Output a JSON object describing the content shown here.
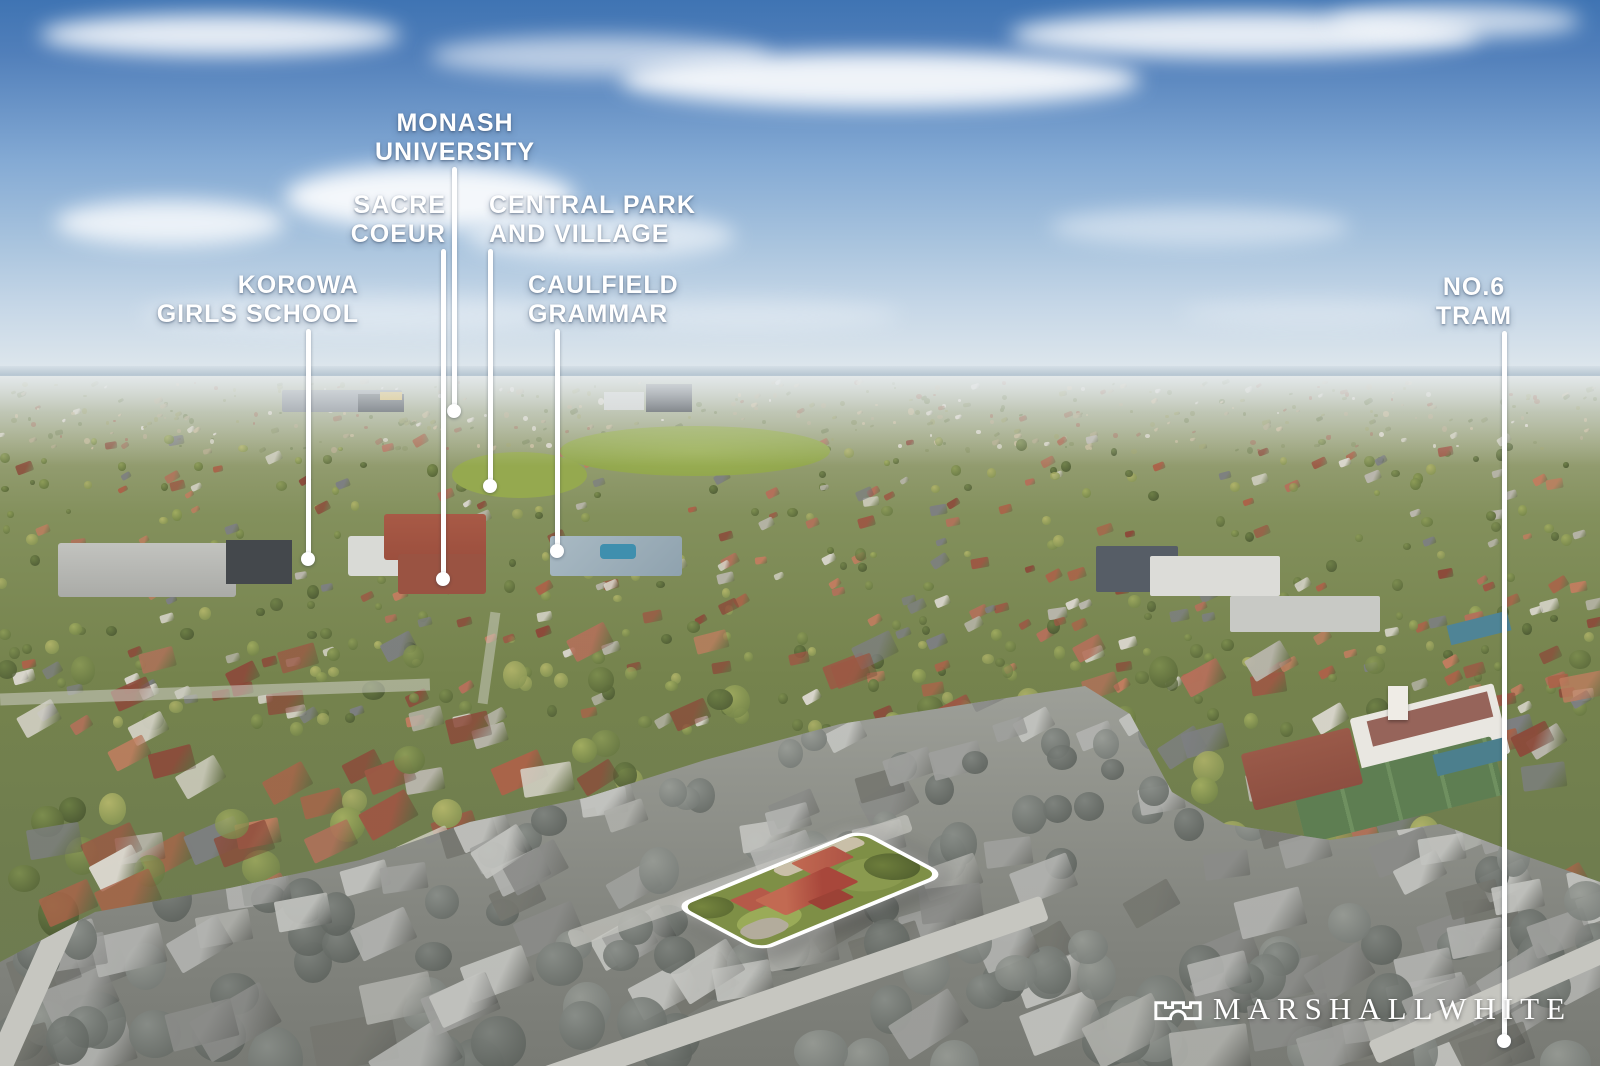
{
  "meta": {
    "description": "Aerial real-estate marketing photograph of a Melbourne suburb with landmark callouts, a white-outlined highlighted property in colour over a desaturated foreground, and agency logo",
    "width": 1600,
    "height": 1066
  },
  "palette": {
    "sky-top": "#3f74b3",
    "sky-mid": "#84aad4",
    "sky-horizon": "#dde6ec",
    "ground-far": "#aab29b",
    "ground-mid": "#75834d",
    "ground-near": "#6e7b52",
    "road-gray": "#c6c6c0",
    "lawn-green": "#7e8f46",
    "roof-red": "#a8473b",
    "callout-white": "#ffffff"
  },
  "callouts": [
    {
      "name": "monash-university",
      "lines": [
        "MONASH",
        "UNIVERSITY"
      ],
      "align": "center",
      "anchor_x": 455,
      "label_top": 109,
      "line_x": 454,
      "line_top": 167,
      "dot_y": 411
    },
    {
      "name": "sacre-coeur",
      "lines": [
        "SACRE",
        "COEUR"
      ],
      "align": "right",
      "anchor_x": 446,
      "label_top": 191,
      "line_x": 443,
      "line_top": 249,
      "dot_y": 579
    },
    {
      "name": "central-park-and-village",
      "lines": [
        "CENTRAL PARK",
        "AND VILLAGE"
      ],
      "align": "left",
      "anchor_x": 489,
      "label_top": 191,
      "line_x": 490,
      "line_top": 249,
      "dot_y": 486
    },
    {
      "name": "korowa-girls-school",
      "lines": [
        "KOROWA",
        "GIRLS SCHOOL"
      ],
      "align": "right",
      "anchor_x": 359,
      "label_top": 271,
      "line_x": 308,
      "line_top": 329,
      "dot_y": 559
    },
    {
      "name": "caulfield-grammar",
      "lines": [
        "CAULFIELD",
        "GRAMMAR"
      ],
      "align": "left",
      "anchor_x": 528,
      "label_top": 271,
      "line_x": 557,
      "line_top": 329,
      "dot_y": 551
    },
    {
      "name": "no6-tram",
      "lines": [
        "NO.6",
        "TRAM"
      ],
      "align": "center",
      "anchor_x": 1474,
      "label_top": 273,
      "line_x": 1504,
      "line_top": 331,
      "dot_y": 1041
    }
  ],
  "logo": {
    "text": "MARSHALLWHITE",
    "icon": "castle-icon"
  },
  "highlight": {
    "name": "property-boundary",
    "style": "white rounded outline, interior in colour, surroundings desaturated"
  }
}
